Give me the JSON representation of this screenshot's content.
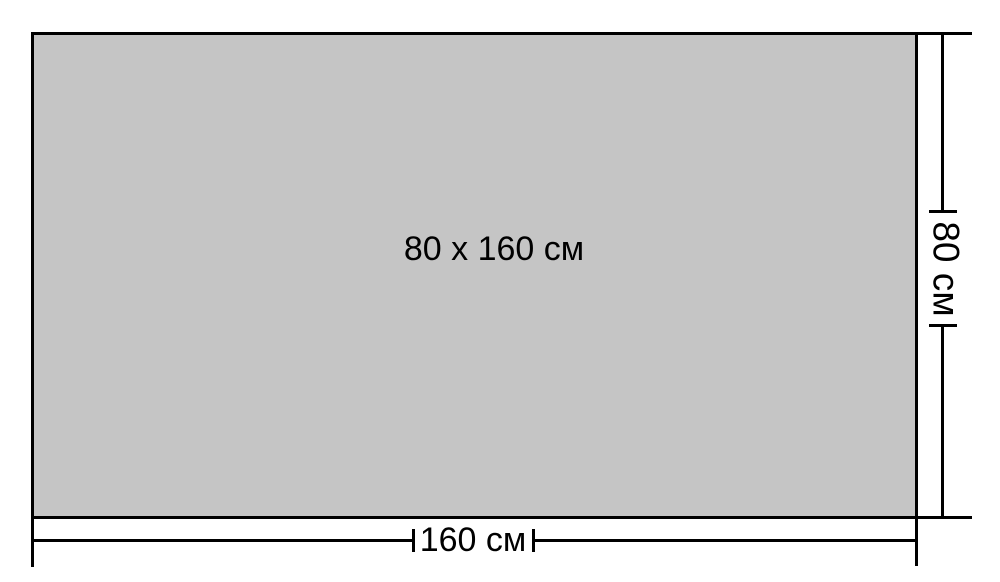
{
  "diagram": {
    "center_label": "80 x 160 см",
    "width_dimension": {
      "label": "160 см",
      "value": 160,
      "unit": "см"
    },
    "height_dimension": {
      "label": "80 см",
      "value": 80,
      "unit": "см"
    },
    "colors": {
      "background": "#ffffff",
      "panel_fill": "#c5c5c5",
      "line": "#000000",
      "text": "#000000"
    }
  }
}
